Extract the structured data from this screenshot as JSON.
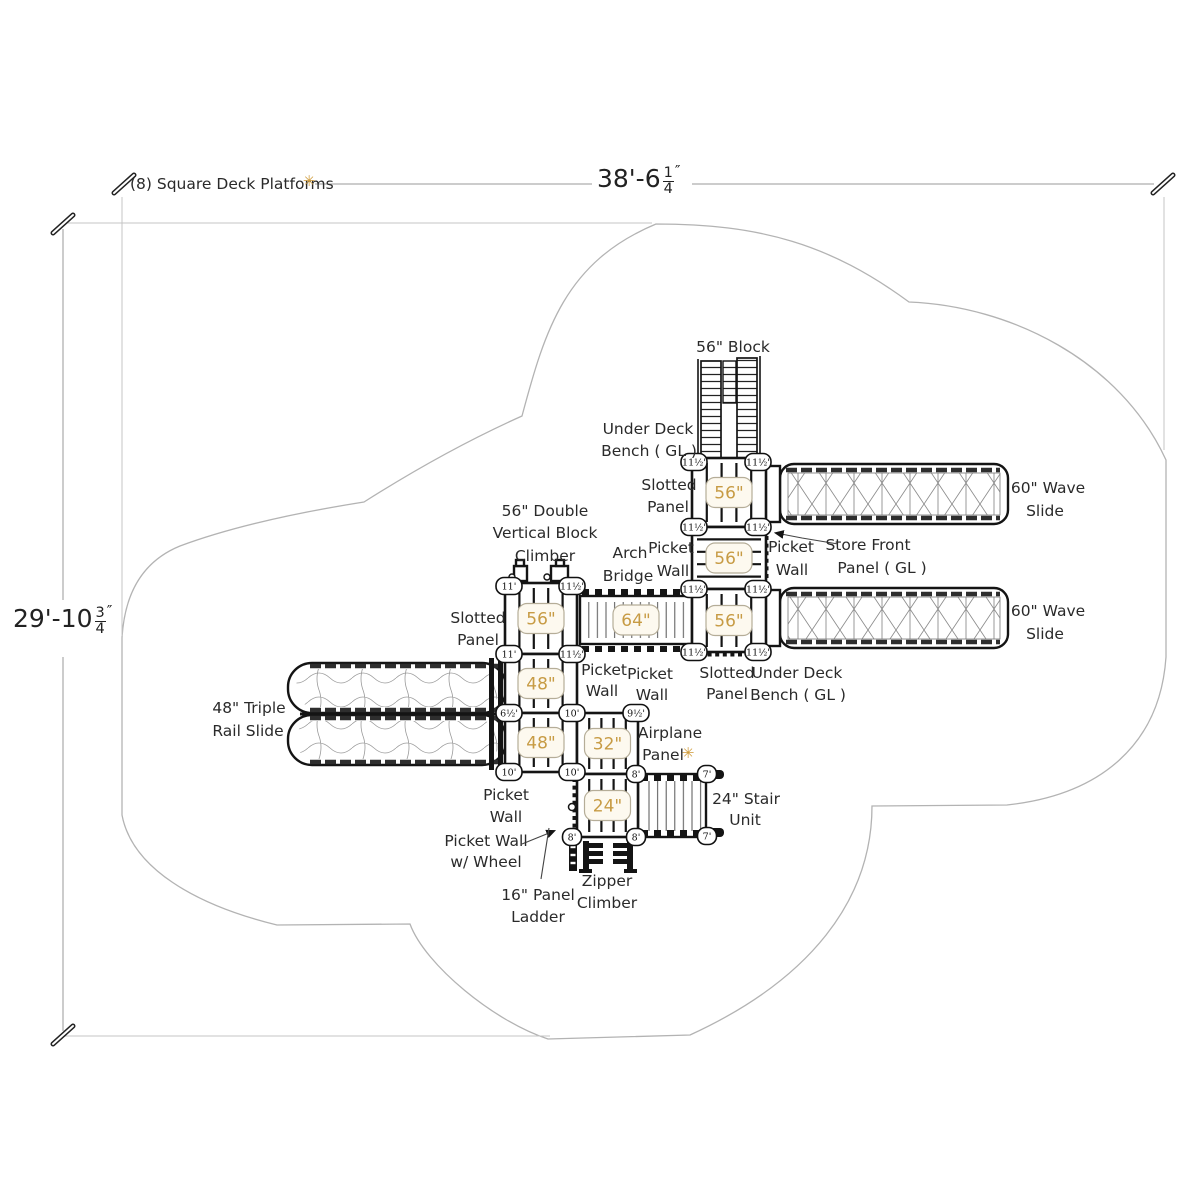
{
  "drawing": {
    "type": "playground equipment plan",
    "note": "(8) Square Deck Platforms",
    "asterisk": "✳"
  },
  "dimensions": {
    "top": {
      "main": "38'-6",
      "num": "1",
      "den": "4",
      "unit": "″"
    },
    "left": {
      "main": "29'-10",
      "num": "3",
      "den": "4",
      "unit": "″"
    }
  },
  "colors": {
    "accent_orange": "#cf9b3a",
    "deck_value_orange": "#c79b44",
    "linework": "#141414",
    "outline_gray": "#b3b3b3"
  },
  "labels": [
    {
      "t": "(8) Square Deck Platforms",
      "x": 130,
      "y": 189,
      "a": "s",
      "n": "platforms-note"
    },
    {
      "t": "✳",
      "x": 309,
      "y": 186,
      "c": "accent",
      "n": "platforms-asterisk"
    },
    {
      "t": "56\" Block",
      "x": 733,
      "y": 352,
      "n": "block-climber-label"
    },
    {
      "t": "Under Deck",
      "x": 648,
      "y": 434
    },
    {
      "t": "Bench ( GL )",
      "x": 649,
      "y": 456
    },
    {
      "t": "Slotted",
      "x": 669,
      "y": 490
    },
    {
      "t": "Panel",
      "x": 668,
      "y": 512
    },
    {
      "t": "60\" Wave",
      "x": 1048,
      "y": 493,
      "n": "wave-slide-1-label"
    },
    {
      "t": "Slide",
      "x": 1045,
      "y": 516
    },
    {
      "t": "60\" Wave",
      "x": 1048,
      "y": 616,
      "n": "wave-slide-2-label"
    },
    {
      "t": "Slide",
      "x": 1045,
      "y": 639
    },
    {
      "t": "Picket",
      "x": 791,
      "y": 552
    },
    {
      "t": "Wall",
      "x": 792,
      "y": 575
    },
    {
      "t": "Store Front",
      "x": 868,
      "y": 550
    },
    {
      "t": "Panel ( GL )",
      "x": 882,
      "y": 573
    },
    {
      "t": "56\" Double",
      "x": 545,
      "y": 516,
      "n": "double-climber-label"
    },
    {
      "t": "Vertical Block",
      "x": 545,
      "y": 538
    },
    {
      "t": "Climber",
      "x": 545,
      "y": 561
    },
    {
      "t": "Arch",
      "x": 630,
      "y": 558,
      "n": "arch-bridge-label"
    },
    {
      "t": "Bridge",
      "x": 628,
      "y": 581
    },
    {
      "t": "Picket",
      "x": 671,
      "y": 553
    },
    {
      "t": "Wall",
      "x": 673,
      "y": 576
    },
    {
      "t": "Slotted",
      "x": 478,
      "y": 623
    },
    {
      "t": "Panel",
      "x": 478,
      "y": 645
    },
    {
      "t": "48\" Triple",
      "x": 249,
      "y": 713,
      "n": "triple-rail-slide-label"
    },
    {
      "t": "Rail Slide",
      "x": 248,
      "y": 736
    },
    {
      "t": "Picket",
      "x": 604,
      "y": 675
    },
    {
      "t": "Wall",
      "x": 602,
      "y": 696
    },
    {
      "t": "Picket",
      "x": 650,
      "y": 679
    },
    {
      "t": "Wall",
      "x": 652,
      "y": 700
    },
    {
      "t": "Slotted",
      "x": 727,
      "y": 678
    },
    {
      "t": "Panel",
      "x": 727,
      "y": 699
    },
    {
      "t": "Under Deck",
      "x": 797,
      "y": 678
    },
    {
      "t": "Bench ( GL )",
      "x": 798,
      "y": 700
    },
    {
      "t": "Airplane",
      "x": 670,
      "y": 738,
      "n": "airplane-panel-label"
    },
    {
      "t": "Panel",
      "x": 663,
      "y": 760
    },
    {
      "t": "✳",
      "x": 688,
      "y": 758,
      "c": "accent",
      "n": "airplane-asterisk"
    },
    {
      "t": "24\" Stair",
      "x": 746,
      "y": 804,
      "n": "stair-unit-label"
    },
    {
      "t": "Unit",
      "x": 745,
      "y": 825
    },
    {
      "t": "Picket",
      "x": 506,
      "y": 800
    },
    {
      "t": "Wall",
      "x": 506,
      "y": 822
    },
    {
      "t": "Picket Wall",
      "x": 486,
      "y": 846
    },
    {
      "t": "w/ Wheel",
      "x": 486,
      "y": 867
    },
    {
      "t": "16\" Panel",
      "x": 538,
      "y": 900,
      "n": "panel-ladder-label"
    },
    {
      "t": "Ladder",
      "x": 538,
      "y": 922
    },
    {
      "t": "Zipper",
      "x": 607,
      "y": 886,
      "n": "zipper-climber-label"
    },
    {
      "t": "Climber",
      "x": 607,
      "y": 908
    }
  ],
  "decks": [
    {
      "x": 692,
      "y": 458,
      "w": 74,
      "h": 69,
      "bars": "v",
      "value": "56\""
    },
    {
      "x": 692,
      "y": 527,
      "w": 74,
      "h": 62,
      "bars": "h",
      "value": "56\""
    },
    {
      "x": 692,
      "y": 589,
      "w": 74,
      "h": 63,
      "bars": "v",
      "value": "56\""
    },
    {
      "x": 505,
      "y": 583,
      "w": 72,
      "h": 71,
      "bars": "v",
      "value": "56\""
    },
    {
      "x": 505,
      "y": 654,
      "w": 72,
      "h": 59,
      "bars": "v",
      "value": "48\""
    },
    {
      "x": 505,
      "y": 713,
      "w": 72,
      "h": 59,
      "bars": "v",
      "value": "48\""
    },
    {
      "x": 577,
      "y": 713,
      "w": 61,
      "h": 61,
      "bars": "v",
      "value": "32\""
    },
    {
      "x": 577,
      "y": 774,
      "w": 61,
      "h": 63,
      "bars": "v",
      "value": "24\""
    },
    {
      "x": 580,
      "y": 595,
      "w": 112,
      "h": 50,
      "bars": "none",
      "value": "64\""
    }
  ],
  "bubbles": [
    [
      694,
      462,
      "11½'"
    ],
    [
      758,
      462,
      "11½'"
    ],
    [
      694,
      527,
      "11½'"
    ],
    [
      758,
      527,
      "11½'"
    ],
    [
      694,
      589,
      "11½'"
    ],
    [
      758,
      589,
      "11½'"
    ],
    [
      694,
      652,
      "11½'"
    ],
    [
      758,
      652,
      "11½'"
    ],
    [
      509,
      586,
      "11'"
    ],
    [
      572,
      586,
      "11½'"
    ],
    [
      509,
      654,
      "11'"
    ],
    [
      572,
      654,
      "11½'"
    ],
    [
      509,
      713,
      "6½'"
    ],
    [
      572,
      713,
      "10'"
    ],
    [
      509,
      772,
      "10'"
    ],
    [
      572,
      772,
      "10'"
    ],
    [
      636,
      713,
      "9½'"
    ],
    [
      636,
      774,
      "8'"
    ],
    [
      572,
      837,
      "8'"
    ],
    [
      636,
      837,
      "8'"
    ],
    [
      707,
      774,
      "7'"
    ],
    [
      707,
      836,
      "7'"
    ]
  ]
}
